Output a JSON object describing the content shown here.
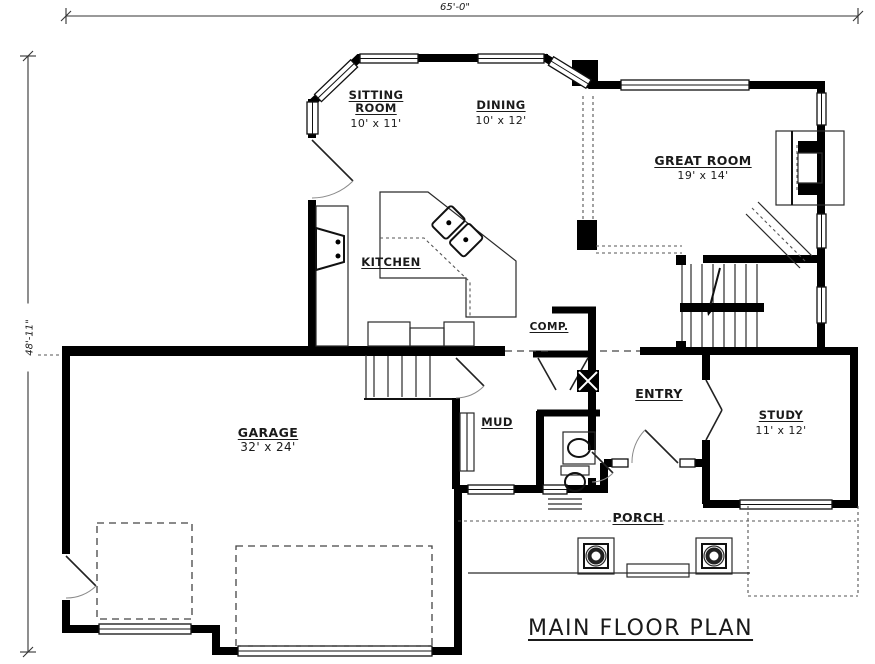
{
  "meta": {
    "plan_title": "MAIN FLOOR PLAN"
  },
  "dimensions": {
    "width": "65'-0\"",
    "height": "48'-11\""
  },
  "rooms": [
    {
      "id": "sitting",
      "name": "SITTING ROOM",
      "size": "10' x 11'"
    },
    {
      "id": "dining",
      "name": "DINING",
      "size": "10' x 12'"
    },
    {
      "id": "great",
      "name": "GREAT ROOM",
      "size": "19' x 14'"
    },
    {
      "id": "kitchen",
      "name": "KITCHEN"
    },
    {
      "id": "comp",
      "name": "COMP."
    },
    {
      "id": "entry",
      "name": "ENTRY"
    },
    {
      "id": "mud",
      "name": "MUD"
    },
    {
      "id": "study",
      "name": "STUDY",
      "size": "11' x 12'"
    },
    {
      "id": "garage",
      "name": "GARAGE",
      "size": "32' x 24'"
    },
    {
      "id": "porch",
      "name": "PORCH"
    }
  ],
  "colors": {
    "wall": "#000000",
    "paper": "#ffffff",
    "line": "#2a2a2a"
  }
}
